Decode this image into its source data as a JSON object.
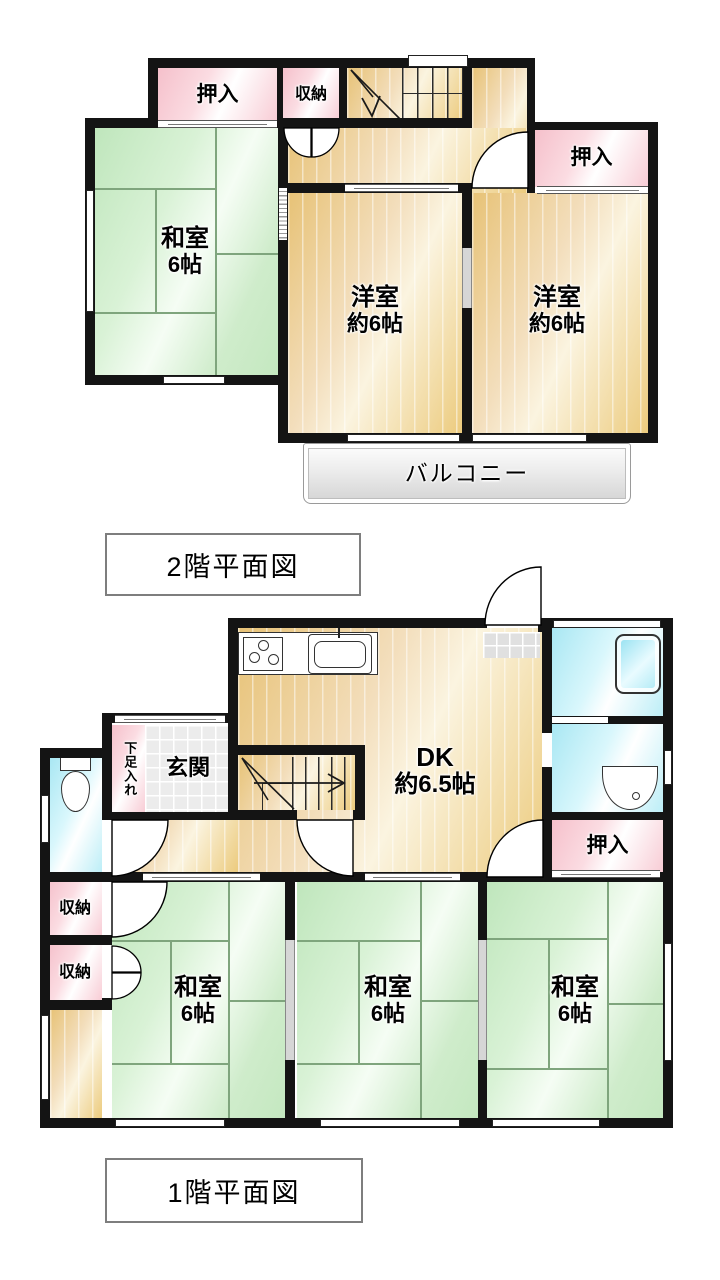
{
  "floor2": {
    "caption": "2階平面図",
    "oshiire_top": {
      "label": "押入"
    },
    "shunou": {
      "label": "収納"
    },
    "washitsu": {
      "name": "和室",
      "size": "6帖"
    },
    "youshitsu_left": {
      "name": "洋室",
      "size": "約6帖"
    },
    "youshitsu_right": {
      "name": "洋室",
      "size": "約6帖"
    },
    "oshiire_right": {
      "label": "押入"
    },
    "balcony": {
      "label": "バルコニー"
    }
  },
  "floor1": {
    "caption": "1階平面図",
    "dk": {
      "name": "DK",
      "size": "約6.5帖"
    },
    "genkan": {
      "label": "玄関"
    },
    "shoe_cabinet": {
      "label": "下足入れ"
    },
    "oshiire": {
      "label": "押入"
    },
    "shunou_upper": {
      "label": "収納"
    },
    "shunou_lower": {
      "label": "収納"
    },
    "washitsu_left": {
      "name": "和室",
      "size": "6帖"
    },
    "washitsu_center": {
      "name": "和室",
      "size": "6帖"
    },
    "washitsu_right": {
      "name": "和室",
      "size": "6帖"
    }
  },
  "colors": {
    "wall": "#141414",
    "tatami_green": "#cdeccb",
    "wood_tan": "#ecc87e",
    "closet_pink": "#f8ccd4",
    "wet_area_blue": "#bfeef6",
    "entry_tile_gray": "#ececec",
    "balcony_gray": "#e2e2e2"
  }
}
